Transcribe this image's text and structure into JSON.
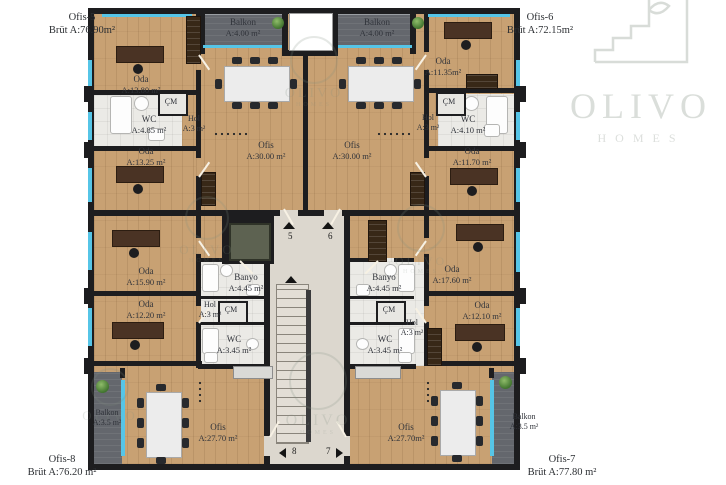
{
  "brand": {
    "name": "OLIVO",
    "tagline": "HOMES"
  },
  "units": {
    "ofis5": {
      "name": "Ofis-5",
      "brut": "Brüt A:76.90m²"
    },
    "ofis6": {
      "name": "Ofis-6",
      "brut": "Brüt A:72.15m²"
    },
    "ofis7": {
      "name": "Ofis-7",
      "brut": "Brüt A:77.80 m²"
    },
    "ofis8": {
      "name": "Ofis-8",
      "brut": "Brüt A:76.20 m²"
    }
  },
  "rooms": {
    "o5_oda1": {
      "n": "Oda",
      "a": "A:13.80 m²"
    },
    "o5_balkon": {
      "n": "Balkon",
      "a": "A:4.00 m²"
    },
    "o5_wc": {
      "n": "WC",
      "a": "A:4.85 m²"
    },
    "o5_cm": {
      "n": "ÇM"
    },
    "o5_hol": {
      "n": "Hol",
      "a": "A:3 m²"
    },
    "o5_ofis": {
      "n": "Ofis",
      "a": "A:30.00 m²"
    },
    "o5_oda2": {
      "n": "Oda",
      "a": "A:13.25 m²"
    },
    "o6_balkon": {
      "n": "Balkon",
      "a": "A:4.00 m²"
    },
    "o6_oda1": {
      "n": "Oda",
      "a": "A:11.35m²"
    },
    "o6_cm": {
      "n": "ÇM"
    },
    "o6_wc": {
      "n": "WC",
      "a": "A:4.10 m²"
    },
    "o6_hol": {
      "n": "Hol",
      "a": "A:3 m²"
    },
    "o6_ofis": {
      "n": "Ofis",
      "a": "A:30.00 m²"
    },
    "o6_oda2": {
      "n": "Oda",
      "a": "A:11.70 m²"
    },
    "o8_oda1": {
      "n": "Oda",
      "a": "A:15.90 m²"
    },
    "o8_banyo": {
      "n": "Banyo",
      "a": "A:4.45 m²"
    },
    "o8_oda2": {
      "n": "Oda",
      "a": "A:12.20 m²"
    },
    "o8_hol": {
      "n": "Hol",
      "a": "A:3 m²"
    },
    "o8_cm": {
      "n": "ÇM"
    },
    "o8_wc": {
      "n": "WC",
      "a": "A:3.45 m²"
    },
    "o8_balkon": {
      "n": "Balkon",
      "a": "A:3.5 m²"
    },
    "o8_ofis": {
      "n": "Ofis",
      "a": "A:27.70 m²"
    },
    "o7_banyo": {
      "n": "Banyo",
      "a": "A:4.45 m²"
    },
    "o7_oda1": {
      "n": "Oda",
      "a": "A:17.60 m²"
    },
    "o7_cm": {
      "n": "ÇM"
    },
    "o7_hol": {
      "n": "Hol",
      "a": "A:3 m²"
    },
    "o7_wc": {
      "n": "WC",
      "a": "A:3.45 m²"
    },
    "o7_oda2": {
      "n": "Oda",
      "a": "A:12.10 m²"
    },
    "o7_ofis": {
      "n": "Ofis",
      "a": "A:27.70m²"
    },
    "o7_balkon": {
      "n": "Balkon",
      "a": "A:3.5 m²"
    }
  },
  "stairs": {
    "m5": "5",
    "m6": "6",
    "m7": "7",
    "m8": "8"
  }
}
